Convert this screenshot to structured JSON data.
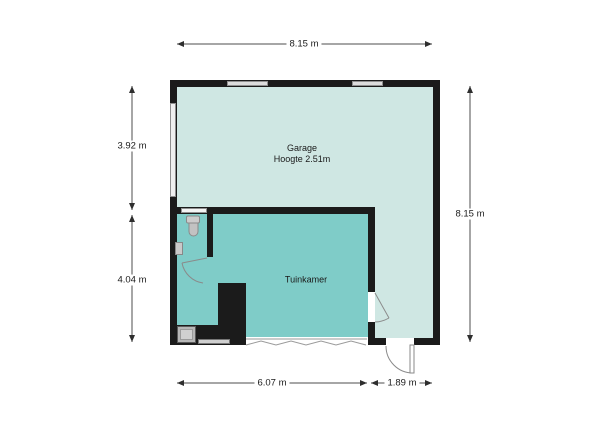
{
  "floorplan": {
    "rooms": {
      "garage": {
        "label": "Garage",
        "height_note": "Hoogte 2.51m"
      },
      "tuinkamer": {
        "label": "Tuinkamer"
      }
    },
    "dimensions": {
      "top_width": "8.15 m",
      "left_upper": "3.92 m",
      "left_lower": "4.04 m",
      "right_height": "8.15 m",
      "bottom_left": "6.07 m",
      "bottom_right": "1.89 m"
    },
    "colors": {
      "garage_fill": "#cfe7e3",
      "tuinkamer_fill": "#7fccc8",
      "wall": "#1b1b1b",
      "window_fill": "#dcdcdc",
      "window_border": "#8f8f8f",
      "door_line": "#8a8a8a",
      "dimension_line": "#4d4d4d",
      "text": "#1a1a1a"
    },
    "icons": {
      "toilet": "toilet-icon",
      "sink": "sink-icon",
      "appliance": "appliance-icon",
      "folding_door": "folding-door-icon",
      "door_swings": "door-swing-icon"
    }
  }
}
